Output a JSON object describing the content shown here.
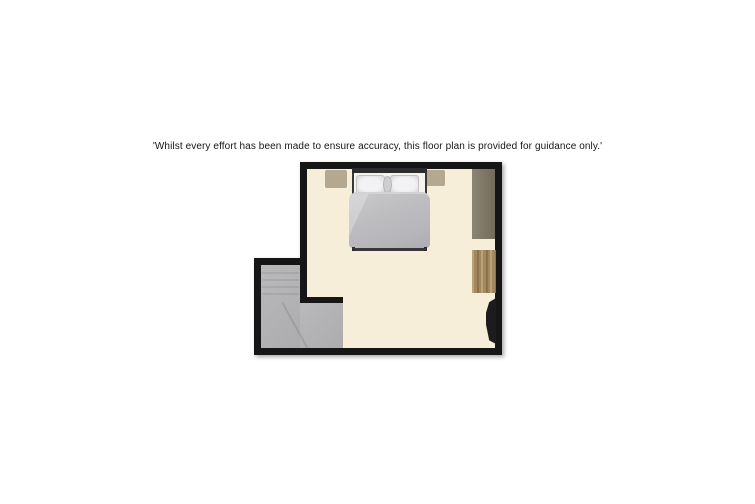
{
  "disclaimer": {
    "text": "'Whilst every effort has been made to ensure accuracy, this floor plan is provided for guidance only.'"
  },
  "floor_plan": {
    "kind": "floorplan",
    "rooms": [
      "bedroom",
      "staircase"
    ],
    "furniture": [
      "double-bed",
      "bedside-table-left",
      "bedside-table-right",
      "wardrobe",
      "chest-of-drawers",
      "tv"
    ]
  },
  "colors": {
    "page_bg": "#ffffff",
    "text": "#151515",
    "wall": "#161616",
    "floor_main": "#f6eed9",
    "floor_stairs": "#acacae",
    "floor_stairs_light": "#b9b9bb",
    "bedside": "#b4a890",
    "wardrobe_light": "#8c8474",
    "wardrobe_dark": "#746c5a",
    "wood_base": "#a2885e",
    "wood_dark": "#8d7349",
    "wood_light": "#bca277",
    "tv": "#1c1c1e",
    "bedframe": "#38383a",
    "duvet": "#bdbdc0",
    "pillow": "#f2f2f4",
    "cushion": "#cfcfd2"
  }
}
